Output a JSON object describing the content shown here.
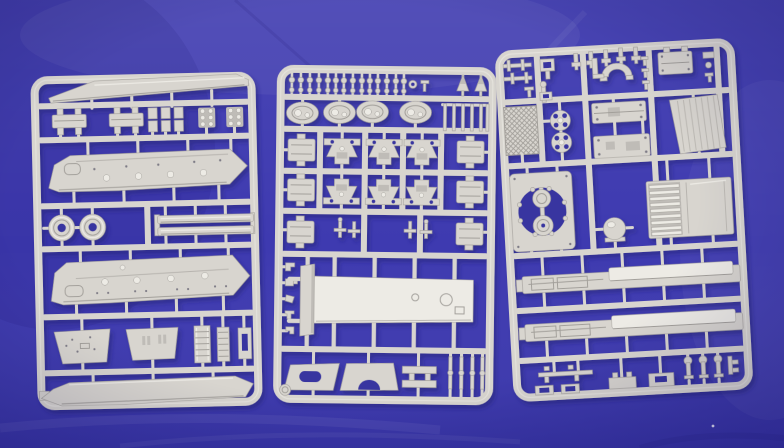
{
  "scene": {
    "type": "photograph",
    "subject": "Three light-grey injection-moulded plastic model kit sprues with unassembled armoured-vehicle parts",
    "surface": "royal blue fabric with soft creases and folds",
    "sprues": [
      {
        "name": "left sprue",
        "parts": [
          "long roof panel",
          "two equipment boxes",
          "three small block fittings",
          "two bolt-head clusters",
          "upper hull side with round hatches",
          "two round idler wheels",
          "two long track rails",
          "lower hull side with round hatches",
          "two trapezoid side panels",
          "two ladder frames",
          "small channel bracket",
          "boat-shaped hull bottom"
        ]
      },
      {
        "name": "middle sprue",
        "parts": [
          "row of fourteen small knob fittings",
          "washer",
          "two tree-shaped fittings",
          "four oval hatches",
          "railing with six posts",
          "six rectangular fittings",
          "six suspension bogie brackets",
          "small antenna fittings",
          "large deck plate with end cap",
          "column of five small clips",
          "two mudguards with cut-outs",
          "double-bar fitting",
          "four suspension rods"
        ]
      },
      {
        "name": "right sprue",
        "parts": [
          "rod and clevis fittings",
          "U-shaped half ring",
          "lugged equipment box",
          "mesh grille panel",
          "two spoked wheels",
          "two engine deck panels",
          "louvred side panel",
          "mounting plate with large round opening and two discs",
          "dome light",
          "wide slatted grille panel",
          "two long side skirts",
          "assorted small brackets and knobs"
        ]
      }
    ]
  },
  "colors": {
    "background_blue": "#3e3ab0",
    "background_blue_dark": "#2b2890",
    "background_blue_light": "#5a57cd",
    "hole_blue": "#3834a0",
    "plastic": "#d8d5cf",
    "plastic_light": "#edebe5",
    "plastic_shadow": "#bfbcb7",
    "plastic_dark": "#a29f9a",
    "shadow_navy": "#232070"
  }
}
